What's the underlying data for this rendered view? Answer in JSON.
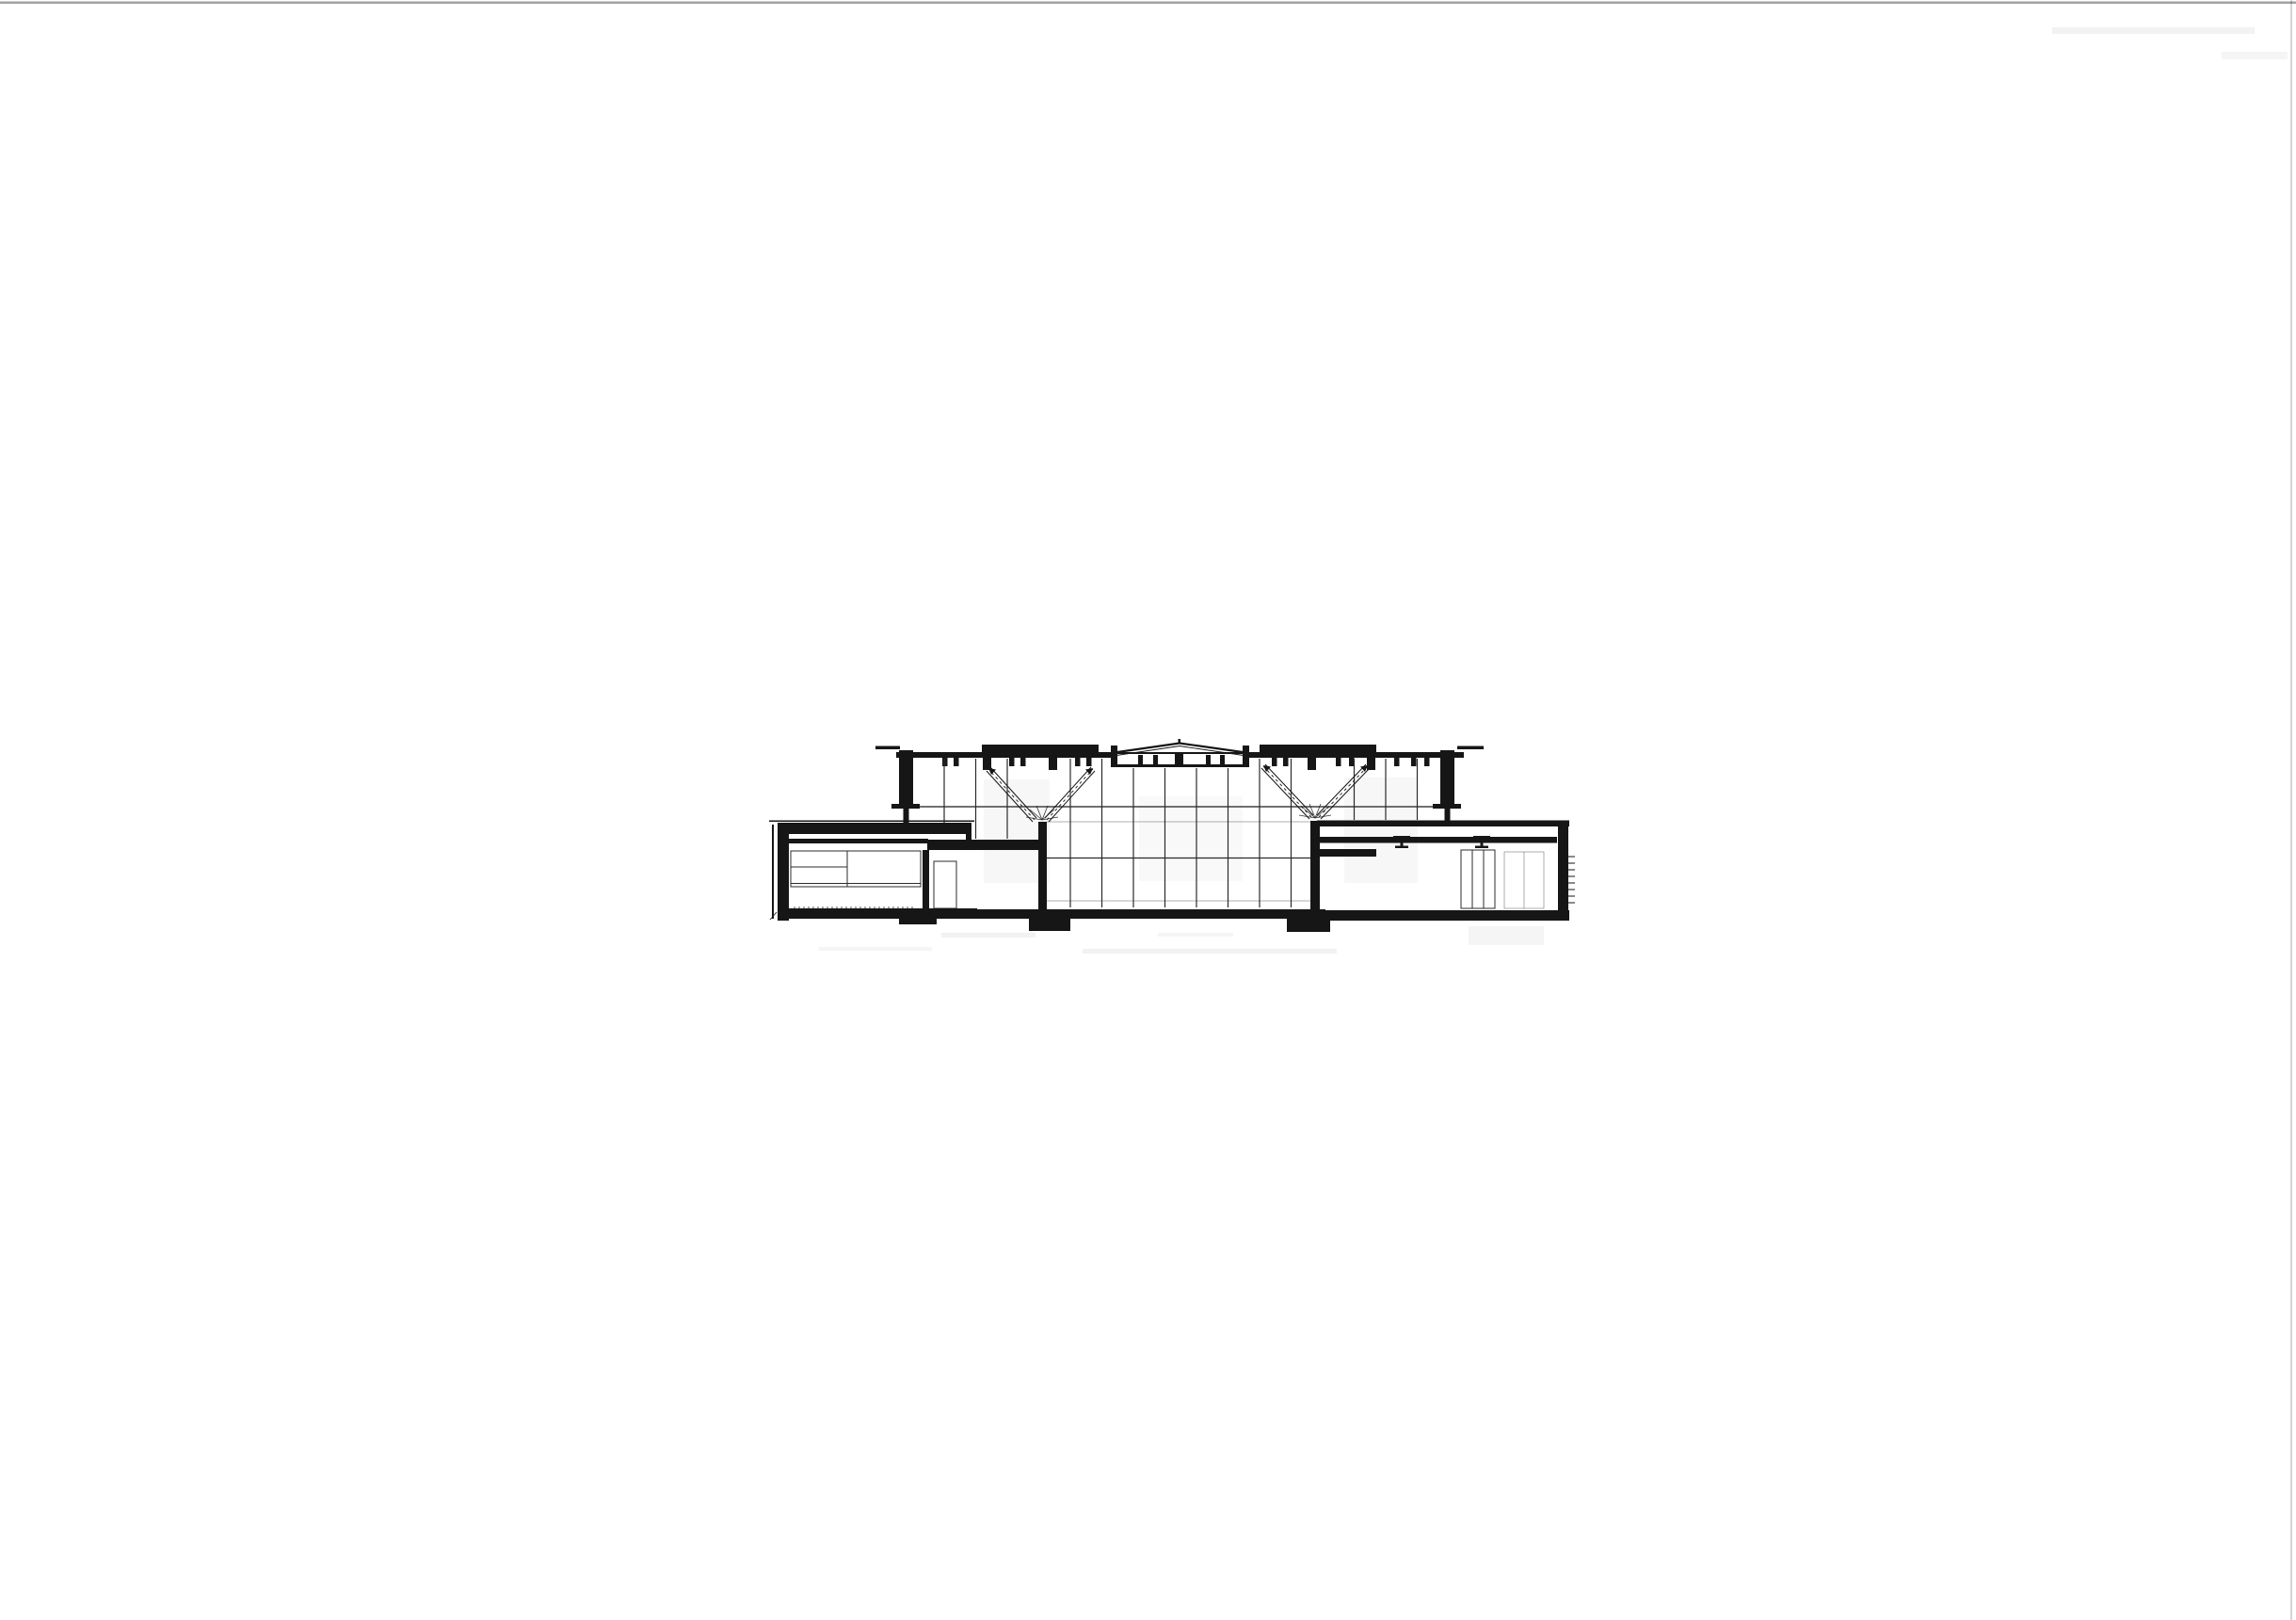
{
  "document": {
    "kind": "scanned architectural drawing",
    "description": "Black-ink building cross-section centered on a blank white sheet; no text, dimensions or labels are printed on the page",
    "visible_text": ""
  },
  "colors": {
    "paper": "#ffffff",
    "ink": "#161616",
    "line": "#2b2b2b",
    "scan": "#9a9a9a"
  },
  "drawing": {
    "components": [
      "left-wing",
      "central-glazed-hall",
      "roof-monitor-lantern",
      "skylight-band-left",
      "skylight-band-right",
      "branching-tree-column-left",
      "branching-tree-column-right",
      "right-wing",
      "floor-slab-and-foundation-pads"
    ]
  }
}
